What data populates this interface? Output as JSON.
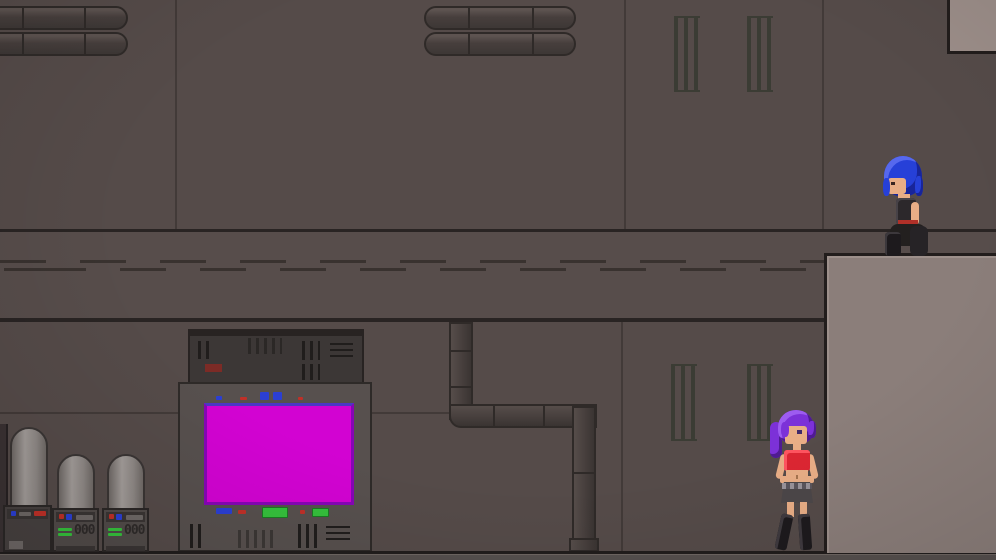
{
  "scene_name": "industrial-platformer-level",
  "colors": {
    "wall": "#554b49",
    "band": "#574d4b",
    "wallseam": "#423a38",
    "banddark": "#292423",
    "banddash": "#39322f",
    "pipe": "#473f3d",
    "pipedark": "#2f2a28",
    "grate": "#3b3c34",
    "platform": "#8b7e7a",
    "platformedge": "#221d1c",
    "box": "#9c8e89",
    "floor": "#56504e",
    "floordark": "#211d1c",
    "floorlight": "#6e6662",
    "cap": "#3c3736",
    "capdark": "#282322",
    "capdetail": "#201d1c",
    "cabinet": "#57504e",
    "cabinetdark": "#2e2a28",
    "screenpink": "#d203d2",
    "screenedge": "#8606b6",
    "screentop": "#4b38c4",
    "green": "#35c13c",
    "red": "#c03028",
    "blue": "#2b3fd4",
    "redlabel": "#7c2b26",
    "machinelight": "#a39d9a",
    "machinemid": "#8e8885",
    "base": "#514b49",
    "basedark": "#2b2726",
    "strip": "#3a3534",
    "slot": "#6e6866",
    "digits": "#2e2a29",
    "skin": "#e9ae86",
    "eyedark": "#3a2520",
    "bluehair": "#2640d8",
    "bluehairhl": "#5668ee",
    "bluehairdk": "#18259a",
    "darkcloth": "#2c282b",
    "rope": "#b03028",
    "purplehair": "#7c31d8",
    "purplehairhl": "#9d5cf0",
    "purplehairdk": "#4f1b92",
    "redtop": "#dd2633",
    "skirt": "#4c4749",
    "belt": "#99939a",
    "boots": "#1d1a1d"
  },
  "machines": {
    "display_left": "000",
    "display_right": "000"
  },
  "characters": {
    "crouching": {
      "name": "blue-haired girl crouching on platform",
      "hair_color": "#2640d8"
    },
    "standing": {
      "name": "purple-haired girl standing by platform",
      "hair_color": "#7c31d8"
    }
  }
}
